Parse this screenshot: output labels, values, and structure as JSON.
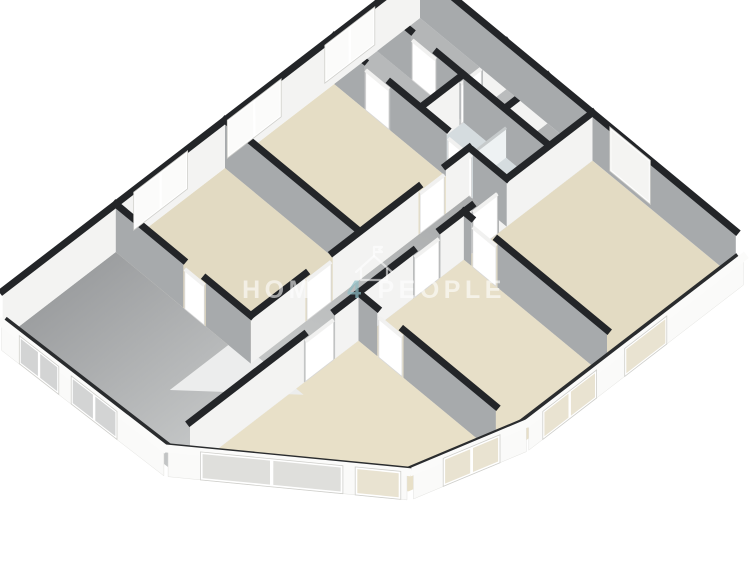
{
  "watermark": {
    "word1": "HOME",
    "word2": "4",
    "word3": "PEOPLE",
    "icon": "house-icon"
  },
  "palette": {
    "background": "#ffffff",
    "wall_top": "#232528",
    "wall_base_shadow": "#2a2c2e",
    "wall_face_light": "#f3f3f2",
    "wall_face_shadow": "#a7aaac",
    "wall_outer": "#fafaf9",
    "wall_top_low": "#fbfbfa",
    "door_leaf": "#ffffff",
    "door_leaf_top": "#f1f1f0",
    "fin_face": "#eef2f3",
    "fin_top": "#c6cacb",
    "window_frame": "#ffffff",
    "window_frame_edge": "#cfcfcb",
    "glass_bright": "#fbfbfa",
    "glass_warm": "#e9e3d1",
    "glass_cool": "#d3d4d4",
    "glass_neutral": "#dfdfdc",
    "floors": {
      "r1": "#b4b6b7",
      "r2": "#babcbd",
      "r3": "#b0b2b3",
      "hall": "#b7b9ba",
      "bath": "#d5dcdf",
      "b1": "#e3dbc3",
      "b2": "#e7dfc8",
      "l1": "#e5ddc5",
      "l2": "#e2dac2",
      "living": "#e8e0c8",
      "stairs": "#eceded",
      "corridor_dark": "#a9abac",
      "corridor_light": "#c3c5c5",
      "gray_dark": "#97999b",
      "gray_light": "#cdcfcf"
    },
    "watermark_white": "rgba(255,255,255,0.58)",
    "watermark_accent": "rgba(142,188,196,0.72)"
  }
}
